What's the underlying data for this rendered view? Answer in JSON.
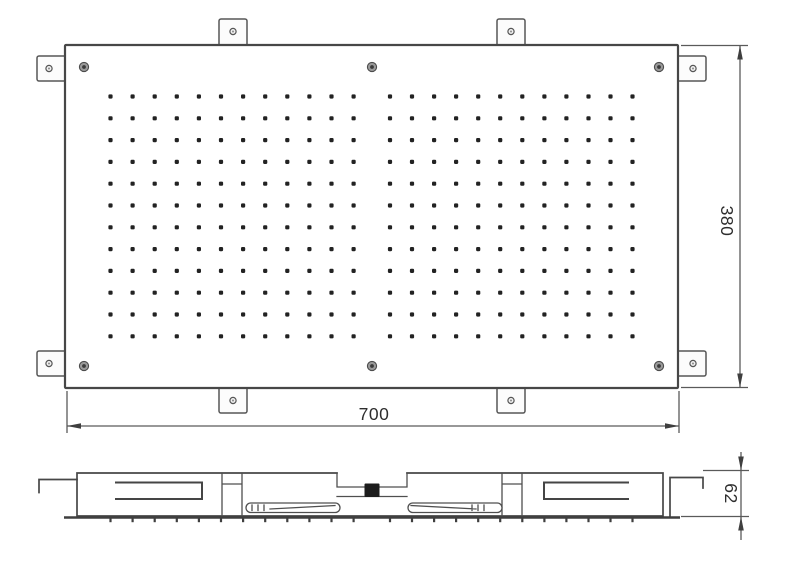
{
  "drawing": {
    "dimensions": {
      "width_label": "700",
      "height_label": "380",
      "depth_label": "62"
    },
    "nozzle_grid": {
      "groups": 2,
      "columns_per_group": 12,
      "rows": 12
    },
    "mounting_tab_count": 8,
    "screw_count": 6,
    "colors": {
      "bg": "#ffffff",
      "line": "#474747",
      "text": "#2e2e2e",
      "fitting": "#1c1c1c"
    }
  }
}
